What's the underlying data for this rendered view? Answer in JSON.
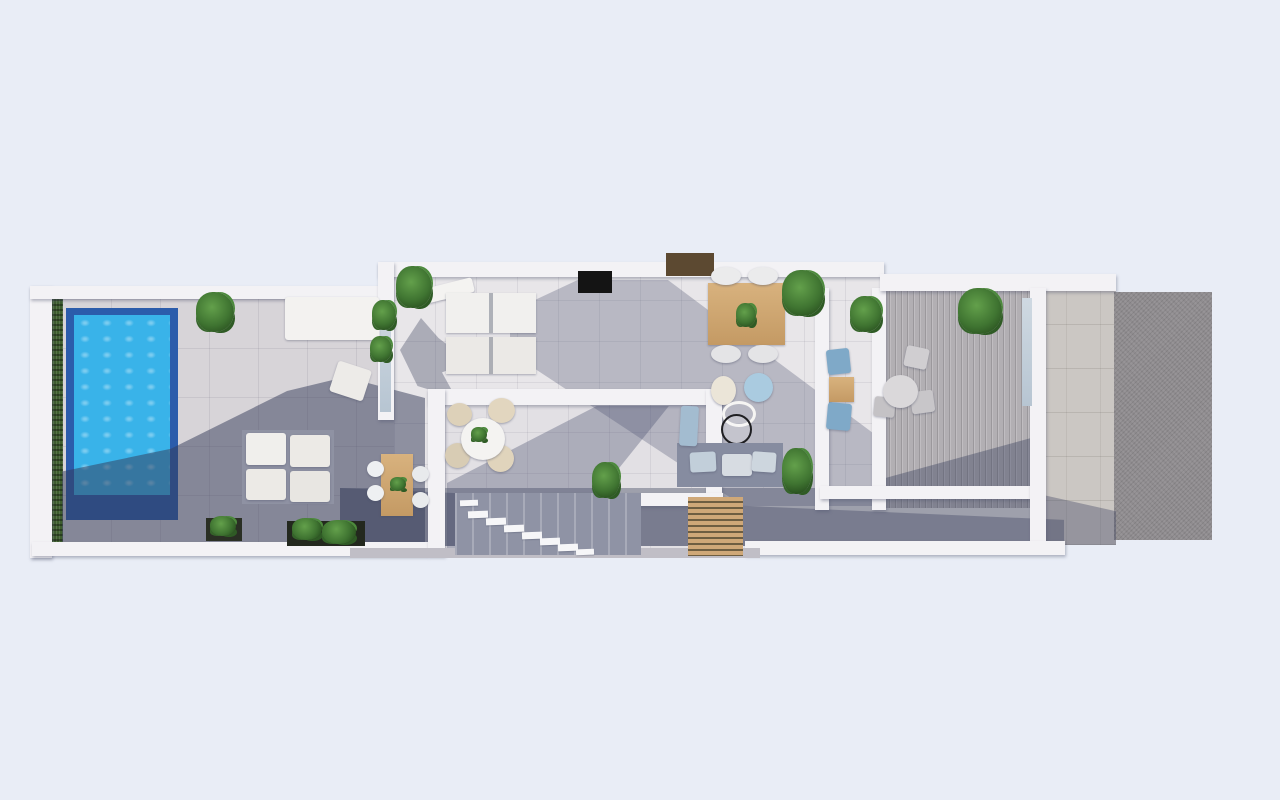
{
  "scene": {
    "description": "3D rendered top-down floor plan of a modern villa: pool terrace with hedge on the left, central living and dining block with inner courtyard and staircase, office hallway, ribbed side terrace, stone path and driveway on the right",
    "background_color": "#e9edf6",
    "palette": {
      "background": "#e9edf6",
      "wall_white": "#f3f2f5",
      "terrace_tile": "#d7d4d8",
      "interior_tile": "#e8e6e9",
      "shadow_deep": "rgba(52,58,88,0.5)",
      "shadow_soft": "rgba(72,78,110,0.3)",
      "pool_water": "#39b3e9",
      "pool_rim": "#2b5cab",
      "hedge_green": "#3d5d2e",
      "plant_green": "#3f7431",
      "wood": "#cda878",
      "dark_wood": "#5c4931",
      "tv_black": "#141414",
      "driveway_gray": "#8f8c8f",
      "ribbed_deck": "#b2afb3",
      "gray_sofa": "#868ca0",
      "blue_accent": "#aacbe0"
    },
    "rooms": [
      "pool-terrace",
      "outdoor-lounge",
      "living-room",
      "dining-area",
      "inner-courtyard",
      "staircase",
      "hallway-office",
      "side-terrace",
      "stone-path",
      "driveway"
    ],
    "elements": [
      {
        "n": "terrace-floor",
        "k": "tile-terrace",
        "x": 62,
        "y": 296,
        "w": 363,
        "h": 249,
        "c": "#d7d4d8"
      },
      {
        "n": "interior-floor",
        "k": "tile-int",
        "x": 394,
        "y": 276,
        "w": 492,
        "h": 230,
        "c": "#e8e6e9"
      },
      {
        "n": "courtyard-floor",
        "k": "tile-int",
        "x": 445,
        "y": 404,
        "w": 262,
        "h": 152,
        "c": "#e2e0e4"
      },
      {
        "n": "corridor-floor",
        "k": "box",
        "x": 340,
        "y": 488,
        "w": 724,
        "h": 58,
        "c": "#9ea0ac"
      },
      {
        "n": "side-terrace-floor",
        "k": "ribbed",
        "x": 884,
        "y": 290,
        "w": 148,
        "h": 218
      },
      {
        "n": "stone-path-floor",
        "k": "stone",
        "x": 1032,
        "y": 290,
        "w": 84,
        "h": 255,
        "c": "#cbc7c3"
      },
      {
        "n": "driveway-floor",
        "k": "drive",
        "x": 1114,
        "y": 292,
        "w": 98,
        "h": 248
      },
      {
        "n": "hedge-strip",
        "k": "hedge",
        "x": 50,
        "y": 294,
        "w": 13,
        "h": 252
      },
      {
        "n": "pool-basin",
        "k": "box",
        "x": 66,
        "y": 308,
        "w": 112,
        "h": 212,
        "c": "#2b5cab"
      },
      {
        "n": "pool-water",
        "k": "pool-water",
        "x": 74,
        "y": 315,
        "w": 96,
        "h": 180
      },
      {
        "n": "terrace-shadow",
        "k": "shadow",
        "x": 62,
        "y": 370,
        "w": 363,
        "h": 175,
        "c": "rgba(52,58,88,0.5)",
        "clip": "polygon(0 58%, 30% 45%, 62% 12%, 78% 4%, 100% 16%, 100% 100%, 0 100%)"
      },
      {
        "n": "interior-shadow",
        "k": "shadow",
        "x": 510,
        "y": 280,
        "w": 376,
        "h": 226,
        "c": "rgba(72,78,110,0.3)",
        "clip": "polygon(18% 0, 42% 0, 100% 72%, 100% 100%, 62% 100%, 0 32%, 0 14%)"
      },
      {
        "n": "courtyard-shadow",
        "k": "shadow",
        "x": 447,
        "y": 406,
        "w": 258,
        "h": 148,
        "c": "rgba(72,78,110,0.35)",
        "clip": "polygon(0 100%, 0 52%, 58% 0, 86% 0, 40% 100%)"
      },
      {
        "n": "corridor-shadow",
        "k": "shadow",
        "x": 340,
        "y": 488,
        "w": 724,
        "h": 58,
        "c": "rgba(52,58,88,0.35)",
        "clip": "polygon(0 0, 100% 55%, 100% 100%, 0 100%)"
      },
      {
        "n": "side-terrace-shadow",
        "k": "shadow",
        "x": 884,
        "y": 430,
        "w": 148,
        "h": 78,
        "c": "rgba(56,62,92,0.4)",
        "clip": "polygon(0 100%, 0 62%, 100% 10%, 100% 100%)"
      },
      {
        "n": "path-shadow",
        "k": "shadow",
        "x": 1032,
        "y": 470,
        "w": 84,
        "h": 75,
        "c": "rgba(52,58,88,0.35)",
        "clip": "polygon(0 30%, 100% 55%, 100% 100%, 0 100%)"
      },
      {
        "n": "palm-shadow",
        "k": "shadow",
        "x": 400,
        "y": 318,
        "w": 70,
        "h": 80,
        "c": "rgba(56,62,92,0.35),",
        "clip": "polygon(0 40%, 30% 0, 55% 25%, 100% 55%, 60% 68%, 80% 100%, 25% 85%)"
      },
      {
        "n": "outer-left-wall",
        "k": "wall",
        "x": 30,
        "y": 286,
        "w": 22,
        "h": 272
      },
      {
        "n": "outer-top-left-wall",
        "k": "wall",
        "x": 30,
        "y": 286,
        "w": 352,
        "h": 13
      },
      {
        "n": "outer-bottom-left-wall",
        "k": "wall",
        "x": 32,
        "y": 542,
        "w": 396,
        "h": 14
      },
      {
        "n": "building-top-wall",
        "k": "wall",
        "x": 378,
        "y": 262,
        "w": 506,
        "h": 15
      },
      {
        "n": "building-left-wall",
        "k": "wall",
        "x": 378,
        "y": 262,
        "w": 16,
        "h": 158
      },
      {
        "n": "left-wall-glass",
        "k": "glass",
        "x": 380,
        "y": 300,
        "w": 11,
        "h": 112
      },
      {
        "n": "courtyard-top-wall",
        "k": "wall",
        "x": 428,
        "y": 389,
        "w": 295,
        "h": 16
      },
      {
        "n": "courtyard-left-wall",
        "k": "wall",
        "x": 428,
        "y": 389,
        "w": 17,
        "h": 167
      },
      {
        "n": "courtyard-right-wall",
        "k": "wall",
        "x": 706,
        "y": 389,
        "w": 16,
        "h": 104
      },
      {
        "n": "courtyard-inner-wall",
        "k": "wall",
        "x": 543,
        "y": 493,
        "w": 180,
        "h": 13
      },
      {
        "n": "hall-left-wall",
        "k": "wall",
        "x": 815,
        "y": 288,
        "w": 14,
        "h": 222
      },
      {
        "n": "hall-right-wall",
        "k": "wall",
        "x": 872,
        "y": 288,
        "w": 14,
        "h": 222
      },
      {
        "n": "hall-bottom-wall",
        "k": "wall",
        "x": 820,
        "y": 486,
        "w": 214,
        "h": 13
      },
      {
        "n": "top-right-wall",
        "k": "wall",
        "x": 880,
        "y": 274,
        "w": 236,
        "h": 17
      },
      {
        "n": "right-divider-wall",
        "k": "wall",
        "x": 1030,
        "y": 288,
        "w": 16,
        "h": 257
      },
      {
        "n": "side-terrace-glass",
        "k": "glass",
        "x": 1022,
        "y": 298,
        "w": 10,
        "h": 108
      },
      {
        "n": "bottom-mid-wall",
        "k": "wall",
        "x": 745,
        "y": 541,
        "w": 320,
        "h": 14
      },
      {
        "n": "bottom-step-strip",
        "k": "box",
        "x": 350,
        "y": 548,
        "w": 410,
        "h": 10,
        "c": "#c0bec6"
      },
      {
        "n": "tv-screen",
        "k": "box",
        "x": 578,
        "y": 271,
        "w": 34,
        "h": 22,
        "c": "#141414"
      },
      {
        "n": "roof-skylight",
        "k": "box",
        "x": 666,
        "y": 253,
        "w": 48,
        "h": 23,
        "c": "#5c4931"
      },
      {
        "n": "daybed",
        "k": "furn",
        "x": 285,
        "y": 297,
        "w": 94,
        "h": 43,
        "c": "#f3f2f0"
      },
      {
        "n": "terrace-armchair",
        "k": "furn",
        "x": 333,
        "y": 365,
        "w": 35,
        "h": 32,
        "c": "#edebe8",
        "r": 18
      },
      {
        "n": "terrace-sofa-base",
        "k": "box",
        "x": 242,
        "y": 430,
        "w": 92,
        "h": 74,
        "c": "#8f92a3"
      },
      {
        "n": "terrace-sofa-cushion",
        "k": "furn",
        "x": 246,
        "y": 433,
        "w": 40,
        "h": 32,
        "c": "#f0efec"
      },
      {
        "n": "terrace-sofa-cushion",
        "k": "furn",
        "x": 290,
        "y": 435,
        "w": 40,
        "h": 32,
        "c": "#eceae6"
      },
      {
        "n": "terrace-sofa-cushion",
        "k": "furn",
        "x": 246,
        "y": 469,
        "w": 40,
        "h": 31,
        "c": "#eceae6"
      },
      {
        "n": "terrace-sofa-cushion",
        "k": "furn",
        "x": 290,
        "y": 471,
        "w": 40,
        "h": 31,
        "c": "#e8e6e2"
      },
      {
        "n": "planter-long",
        "k": "box",
        "x": 287,
        "y": 521,
        "w": 78,
        "h": 25,
        "c": "#23281e"
      },
      {
        "n": "planter-plant",
        "k": "plant",
        "x": 292,
        "y": 518,
        "w": 30,
        "h": 22
      },
      {
        "n": "planter-plant",
        "k": "plant",
        "x": 322,
        "y": 520,
        "w": 34,
        "h": 24
      },
      {
        "n": "planter-small",
        "k": "box",
        "x": 206,
        "y": 518,
        "w": 36,
        "h": 23,
        "c": "#2a2f24"
      },
      {
        "n": "planter-small-plant",
        "k": "plant",
        "x": 210,
        "y": 516,
        "w": 26,
        "h": 20
      },
      {
        "n": "outdoor-table-wood",
        "k": "wood",
        "x": 381,
        "y": 454,
        "w": 32,
        "h": 62
      },
      {
        "n": "outdoor-chair",
        "k": "chair",
        "x": 367,
        "y": 461,
        "w": 17,
        "h": 16,
        "c": "#eef0f2"
      },
      {
        "n": "outdoor-chair",
        "k": "chair",
        "x": 367,
        "y": 485,
        "w": 17,
        "h": 16,
        "c": "#eef0f2"
      },
      {
        "n": "outdoor-chair",
        "k": "chair",
        "x": 412,
        "y": 466,
        "w": 17,
        "h": 16,
        "c": "#e8eaec"
      },
      {
        "n": "outdoor-chair",
        "k": "chair",
        "x": 412,
        "y": 492,
        "w": 17,
        "h": 16,
        "c": "#e8eaec"
      },
      {
        "n": "outdoor-table-leaves",
        "k": "plant",
        "x": 390,
        "y": 477,
        "w": 16,
        "h": 14
      },
      {
        "n": "living-sofa-back",
        "k": "furn",
        "x": 424,
        "y": 283,
        "w": 50,
        "h": 15,
        "c": "#f4f3f1",
        "r": -14
      },
      {
        "n": "living-sofa-a",
        "k": "sofa2",
        "x": 446,
        "y": 293,
        "w": 90,
        "h": 40,
        "c": "#f1f0ee"
      },
      {
        "n": "living-sofa-b",
        "k": "sofa2",
        "x": 446,
        "y": 337,
        "w": 90,
        "h": 37,
        "c": "#ebe9e6"
      },
      {
        "n": "dining-table-wood",
        "k": "wood",
        "x": 708,
        "y": 283,
        "w": 77,
        "h": 62
      },
      {
        "n": "dining-chair",
        "k": "chair",
        "x": 711,
        "y": 267,
        "w": 30,
        "h": 18,
        "c": "#ebebec"
      },
      {
        "n": "dining-chair",
        "k": "chair",
        "x": 748,
        "y": 267,
        "w": 30,
        "h": 18,
        "c": "#ebebec"
      },
      {
        "n": "dining-chair",
        "k": "chair",
        "x": 711,
        "y": 345,
        "w": 30,
        "h": 18,
        "c": "#e4e4e6"
      },
      {
        "n": "dining-chair",
        "k": "chair",
        "x": 748,
        "y": 345,
        "w": 30,
        "h": 18,
        "c": "#e4e4e6"
      },
      {
        "n": "dining-table-plant",
        "k": "plant",
        "x": 736,
        "y": 303,
        "w": 20,
        "h": 24
      },
      {
        "n": "pouf-cream",
        "k": "chair",
        "x": 711,
        "y": 376,
        "w": 25,
        "h": 29,
        "c": "#ebe5d8"
      },
      {
        "n": "pouf-blue",
        "k": "chair",
        "x": 744,
        "y": 373,
        "w": 29,
        "h": 29,
        "c": "#aacbe0"
      },
      {
        "n": "ring-chair",
        "k": "ring",
        "x": 722,
        "y": 401,
        "w": 34,
        "h": 26
      },
      {
        "n": "round-floor-lamp",
        "k": "ring-black",
        "x": 721,
        "y": 414,
        "w": 31,
        "h": 31
      },
      {
        "n": "gray-sofa",
        "k": "box",
        "x": 677,
        "y": 443,
        "w": 106,
        "h": 44,
        "c": "#868ca0"
      },
      {
        "n": "gray-sofa-cushion",
        "k": "furn",
        "x": 690,
        "y": 452,
        "w": 26,
        "h": 20,
        "c": "#c2cfda",
        "r": -3
      },
      {
        "n": "gray-sofa-cushion",
        "k": "furn",
        "x": 722,
        "y": 454,
        "w": 30,
        "h": 22,
        "c": "#d7dce2"
      },
      {
        "n": "gray-sofa-cushion",
        "k": "furn",
        "x": 752,
        "y": 452,
        "w": 24,
        "h": 20,
        "c": "#cdd6de",
        "r": 4
      },
      {
        "n": "chaise-blue",
        "k": "furn",
        "x": 680,
        "y": 406,
        "w": 18,
        "h": 40,
        "c": "#a3bcd0",
        "r": 3
      },
      {
        "n": "hall-chair-blue",
        "k": "furn",
        "x": 827,
        "y": 349,
        "w": 23,
        "h": 25,
        "c": "#7fa9c8",
        "r": -6
      },
      {
        "n": "hall-desk-wood",
        "k": "wood",
        "x": 829,
        "y": 377,
        "w": 25,
        "h": 25
      },
      {
        "n": "hall-chair-blue",
        "k": "furn",
        "x": 827,
        "y": 403,
        "w": 24,
        "h": 27,
        "c": "#7fa9c8",
        "r": 5
      },
      {
        "n": "courtyard-chair",
        "k": "chair",
        "x": 447,
        "y": 403,
        "w": 25,
        "h": 23,
        "c": "#ddd1b9"
      },
      {
        "n": "courtyard-chair",
        "k": "chair",
        "x": 488,
        "y": 398,
        "w": 27,
        "h": 25,
        "c": "#e2d6bf"
      },
      {
        "n": "courtyard-chair",
        "k": "chair",
        "x": 445,
        "y": 443,
        "w": 25,
        "h": 25,
        "c": "#d8ccb4"
      },
      {
        "n": "courtyard-chair",
        "k": "chair",
        "x": 487,
        "y": 445,
        "w": 27,
        "h": 27,
        "c": "#e0d4bc"
      },
      {
        "n": "courtyard-round-table",
        "k": "chair",
        "x": 461,
        "y": 418,
        "w": 44,
        "h": 42,
        "c": "#f4f3f1"
      },
      {
        "n": "courtyard-table-plant",
        "k": "plant",
        "x": 471,
        "y": 427,
        "w": 16,
        "h": 15
      },
      {
        "n": "side-terrace-chair",
        "k": "furn",
        "x": 905,
        "y": 347,
        "w": 23,
        "h": 21,
        "c": "#d0ced1",
        "r": 12
      },
      {
        "n": "side-terrace-chair",
        "k": "furn",
        "x": 911,
        "y": 391,
        "w": 23,
        "h": 22,
        "c": "#c8c6c9",
        "r": -8
      },
      {
        "n": "side-terrace-chair",
        "k": "furn",
        "x": 874,
        "y": 397,
        "w": 21,
        "h": 20,
        "c": "#c4c2c5",
        "r": 6
      },
      {
        "n": "side-terrace-table",
        "k": "chair",
        "x": 883,
        "y": 375,
        "w": 35,
        "h": 33,
        "c": "#dad8da"
      },
      {
        "n": "terrace-plant-pot",
        "k": "wood",
        "x": 962,
        "y": 300,
        "w": 24,
        "h": 20
      },
      {
        "n": "terrace-pot-plant",
        "k": "plant",
        "x": 958,
        "y": 288,
        "w": 44,
        "h": 46
      },
      {
        "n": "pergola-slats",
        "k": "slats",
        "x": 688,
        "y": 497,
        "w": 55,
        "h": 59
      },
      {
        "n": "staircase",
        "k": "stairs",
        "x": 455,
        "y": 493,
        "w": 186,
        "h": 62
      },
      {
        "n": "stair-step",
        "k": "step",
        "x": 460,
        "y": 500,
        "w": 18,
        "h": 6,
        "r": -2
      },
      {
        "n": "stair-step",
        "k": "step",
        "x": 468,
        "y": 511,
        "w": 20,
        "h": 7,
        "r": -2
      },
      {
        "n": "stair-step",
        "k": "step",
        "x": 486,
        "y": 518,
        "w": 20,
        "h": 7,
        "r": -2
      },
      {
        "n": "stair-step",
        "k": "step",
        "x": 504,
        "y": 525,
        "w": 20,
        "h": 7,
        "r": -2
      },
      {
        "n": "stair-step",
        "k": "step",
        "x": 522,
        "y": 532,
        "w": 20,
        "h": 7,
        "r": -2
      },
      {
        "n": "stair-step",
        "k": "step",
        "x": 540,
        "y": 538,
        "w": 20,
        "h": 7,
        "r": -2
      },
      {
        "n": "stair-step",
        "k": "step",
        "x": 558,
        "y": 544,
        "w": 20,
        "h": 7,
        "r": -2
      },
      {
        "n": "stair-step",
        "k": "step",
        "x": 576,
        "y": 549,
        "w": 18,
        "h": 6,
        "r": -2
      },
      {
        "n": "plant-terrace-top",
        "k": "plant",
        "x": 196,
        "y": 292,
        "w": 38,
        "h": 40
      },
      {
        "n": "plant-interior-corner",
        "k": "plant",
        "x": 396,
        "y": 266,
        "w": 36,
        "h": 42
      },
      {
        "n": "plant-left-wall",
        "k": "plant",
        "x": 372,
        "y": 300,
        "w": 24,
        "h": 30
      },
      {
        "n": "plant-left-wall",
        "k": "plant",
        "x": 370,
        "y": 336,
        "w": 22,
        "h": 26
      },
      {
        "n": "plant-dining-right",
        "k": "plant",
        "x": 782,
        "y": 270,
        "w": 42,
        "h": 46
      },
      {
        "n": "plant-hall-top",
        "k": "plant",
        "x": 850,
        "y": 296,
        "w": 32,
        "h": 36
      },
      {
        "n": "plant-courtyard",
        "k": "plant",
        "x": 592,
        "y": 462,
        "w": 28,
        "h": 36
      },
      {
        "n": "plant-sofa-right",
        "k": "plant",
        "x": 782,
        "y": 448,
        "w": 30,
        "h": 46
      }
    ]
  }
}
